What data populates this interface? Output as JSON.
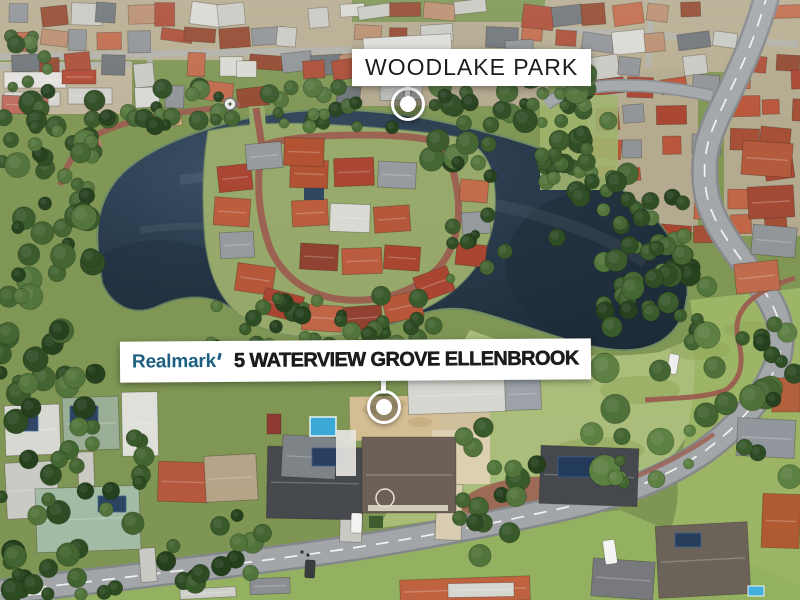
{
  "park_label": {
    "text": "WOODLAKE PARK"
  },
  "property_label": {
    "brand": "Realmark",
    "address": "5 WATERVIEW GROVE ELLENBROOK"
  },
  "colors": {
    "label_background": "#ffffff",
    "label_text": "#1c1c1a",
    "brand_blue": "#1d5f80",
    "marker_white": "#ffffff",
    "lake_water": "#27394a",
    "lake_deep": "#1b2936",
    "grass_green": "#8fae5e",
    "park_grass": "#a9bd79",
    "road_gray": "#a2a6a8",
    "road_casing": "#84888a",
    "brick_path": "#9a5c4e",
    "sand_lot": "#d3bd92",
    "roof_terracotta": "#b4543a"
  }
}
